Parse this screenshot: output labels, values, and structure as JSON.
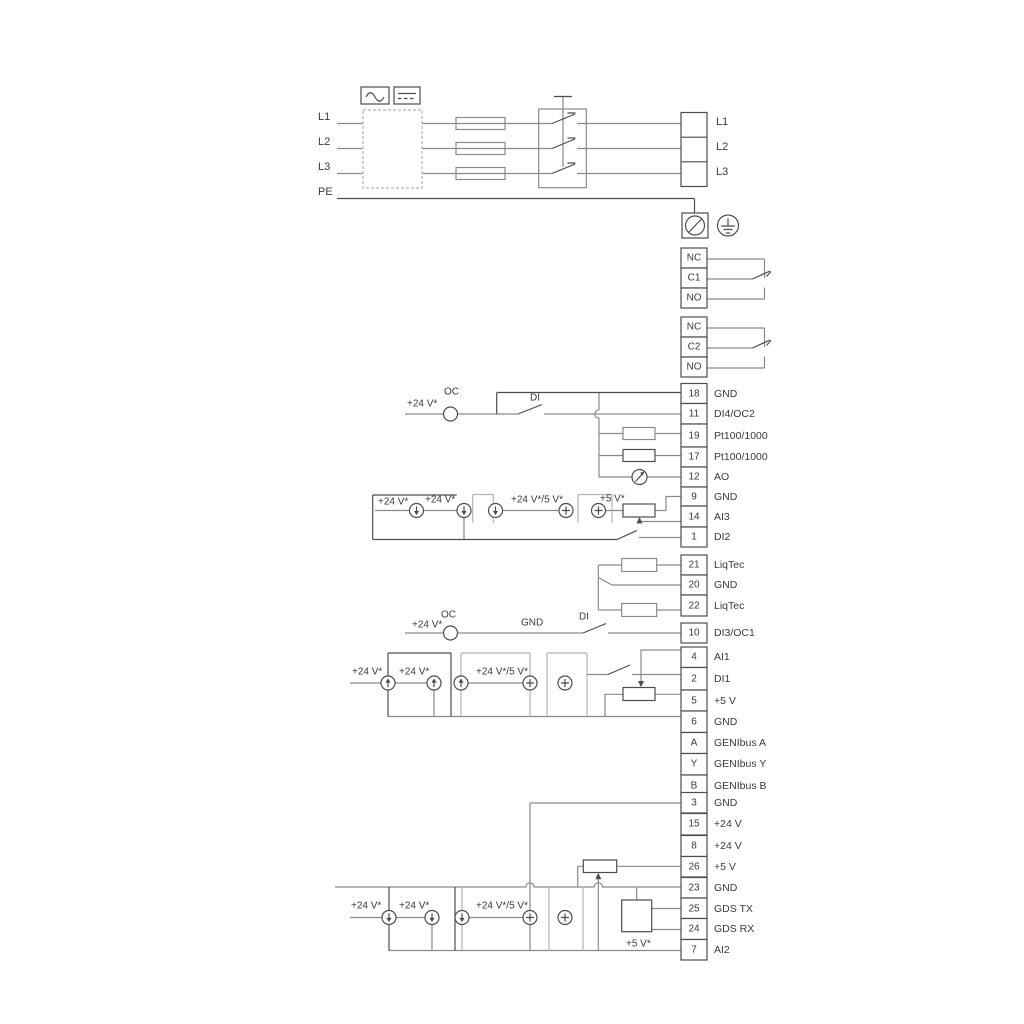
{
  "mains": {
    "inputs": [
      "L1",
      "L2",
      "L3",
      "PE"
    ],
    "outputs": [
      "L1",
      "L2",
      "L3"
    ]
  },
  "relay1": [
    "NC",
    "C1",
    "NO"
  ],
  "relay2": [
    "NC",
    "C2",
    "NO"
  ],
  "block1": [
    {
      "n": "18",
      "l": "GND"
    },
    {
      "n": "11",
      "l": "DI4/OC2"
    },
    {
      "n": "19",
      "l": "Pt100/1000"
    },
    {
      "n": "17",
      "l": "Pt100/1000"
    },
    {
      "n": "12",
      "l": "AO"
    },
    {
      "n": "9",
      "l": "GND"
    },
    {
      "n": "14",
      "l": "AI3"
    },
    {
      "n": "1",
      "l": "DI2"
    }
  ],
  "liqtec": [
    {
      "n": "21",
      "l": "LiqTec"
    },
    {
      "n": "20",
      "l": "GND"
    },
    {
      "n": "22",
      "l": "LiqTec"
    }
  ],
  "di3": [
    {
      "n": "10",
      "l": "DI3/OC1"
    }
  ],
  "block2": [
    {
      "n": "4",
      "l": "AI1"
    },
    {
      "n": "2",
      "l": "DI1"
    },
    {
      "n": "5",
      "l": "+5 V"
    },
    {
      "n": "6",
      "l": "GND"
    },
    {
      "n": "A",
      "l": "GENIbus A"
    },
    {
      "n": "Y",
      "l": "GENIbus Y"
    },
    {
      "n": "B",
      "l": "GENIbus B"
    }
  ],
  "block3": [
    {
      "n": "3",
      "l": "GND"
    },
    {
      "n": "15",
      "l": "+24 V"
    },
    {
      "n": "8",
      "l": "+24 V"
    },
    {
      "n": "26",
      "l": "+5 V"
    },
    {
      "n": "23",
      "l": "GND"
    },
    {
      "n": "25",
      "l": "GDS TX"
    },
    {
      "n": "24",
      "l": "GDS RX"
    },
    {
      "n": "7",
      "l": "AI2"
    }
  ],
  "labels": {
    "v24_top": "+24 V*",
    "oc_top": "OC",
    "di_top": "DI",
    "ai3_v24_1": "+24 V*",
    "ai3_v24_2": "+24 V*",
    "ai3_v245": "+24 V*/5 V*",
    "ai3_v5": "+5 V*",
    "v24_mid": "+24 V*",
    "oc_mid": "OC",
    "gnd_mid": "GND",
    "di_mid": "DI",
    "ai1_v24_1": "+24 V*",
    "ai1_v24_2": "+24 V*",
    "ai1_v245": "+24 V*/5 V*",
    "bot_v24_1": "+24 V*",
    "bot_v24_2": "+24 V*",
    "bot_v245": "+24 V*/5 V*",
    "bot_v5": "+5 V*"
  }
}
